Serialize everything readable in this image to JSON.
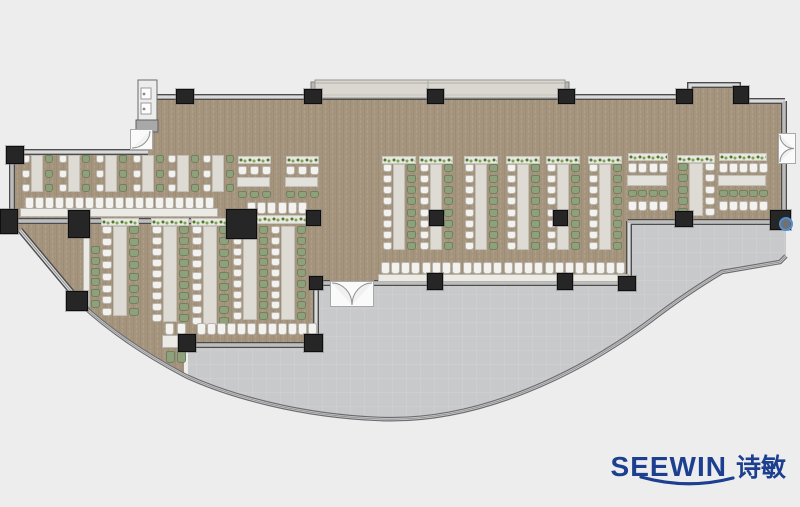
{
  "logo": {
    "brand": "SEEWIN",
    "brand_cn": "诗敏"
  },
  "meta": {
    "background": "#ededee",
    "wood_floor": "#a6957e",
    "terrace": "#c8c9cb",
    "wall_edge": "#4c4c4c",
    "wall_fill": "#dadada",
    "column_color": "#262626",
    "desk": "#dedbd4",
    "chair_white": "#f3f2ef",
    "chair_green": "#8fa07c",
    "plant_green": "#4e7a2d",
    "brand_blue": "#1c3f90",
    "marker_blue": "#4d8fd6"
  },
  "plan": {
    "clusters": [
      {
        "t": "v",
        "x": 381,
        "y": 156,
        "w": 36,
        "h": 94,
        "p": 1,
        "n": 8
      },
      {
        "t": "v",
        "x": 418,
        "y": 156,
        "w": 36,
        "h": 94,
        "p": 1,
        "n": 8
      },
      {
        "t": "v",
        "x": 463,
        "y": 156,
        "w": 36,
        "h": 94,
        "p": 1,
        "n": 8
      },
      {
        "t": "v",
        "x": 505,
        "y": 156,
        "w": 36,
        "h": 94,
        "p": 1,
        "n": 8
      },
      {
        "t": "v",
        "x": 545,
        "y": 156,
        "w": 36,
        "h": 94,
        "p": 1,
        "n": 8
      },
      {
        "t": "v",
        "x": 587,
        "y": 156,
        "w": 36,
        "h": 94,
        "p": 1,
        "n": 8
      },
      {
        "t": "v",
        "x": 20,
        "y": 155,
        "w": 34,
        "h": 37,
        "p": 0,
        "n": 3
      },
      {
        "t": "v",
        "x": 57,
        "y": 155,
        "w": 34,
        "h": 37,
        "p": 0,
        "n": 3
      },
      {
        "t": "v",
        "x": 94,
        "y": 155,
        "w": 34,
        "h": 37,
        "p": 0,
        "n": 3
      },
      {
        "t": "v",
        "x": 131,
        "y": 155,
        "w": 34,
        "h": 37,
        "p": 0,
        "n": 3
      },
      {
        "t": "v",
        "x": 166,
        "y": 155,
        "w": 34,
        "h": 37,
        "p": 0,
        "n": 3
      },
      {
        "t": "v",
        "x": 201,
        "y": 155,
        "w": 34,
        "h": 37,
        "p": 0,
        "n": 3
      },
      {
        "t": "v",
        "x": 100,
        "y": 218,
        "w": 40,
        "h": 98,
        "p": 1,
        "n": 8
      },
      {
        "t": "v",
        "x": 150,
        "y": 218,
        "w": 40,
        "h": 104,
        "p": 1,
        "n": 9
      },
      {
        "t": "v",
        "x": 190,
        "y": 218,
        "w": 40,
        "h": 107,
        "p": 1,
        "n": 9
      },
      {
        "t": "v",
        "x": 231,
        "y": 226,
        "w": 38,
        "h": 94,
        "p": 0,
        "n": 9
      },
      {
        "t": "v",
        "x": 269,
        "y": 226,
        "w": 38,
        "h": 94,
        "p": 0,
        "n": 9
      },
      {
        "t": "v",
        "x": 676,
        "y": 155,
        "w": 40,
        "h": 61,
        "p": 1,
        "n": 5,
        "rev": 1
      },
      {
        "t": "h",
        "x": 237,
        "y": 156,
        "w": 35,
        "rows": [
          [
            "p",
            8
          ],
          [
            "w",
            13
          ],
          [
            "t",
            12
          ],
          [
            "g",
            11
          ]
        ]
      },
      {
        "t": "h",
        "x": 285,
        "y": 156,
        "w": 35,
        "rows": [
          [
            "p",
            8
          ],
          [
            "w",
            13
          ],
          [
            "t",
            12
          ],
          [
            "g",
            11
          ]
        ]
      },
      {
        "t": "h",
        "x": 627,
        "y": 153,
        "w": 42,
        "rows": [
          [
            "p",
            8
          ],
          [
            "w",
            14
          ],
          [
            "t",
            13
          ],
          [
            "g",
            11
          ],
          [
            "w",
            14
          ]
        ]
      },
      {
        "t": "h",
        "x": 718,
        "y": 153,
        "w": 50,
        "rows": [
          [
            "p",
            8
          ],
          [
            "w",
            14
          ],
          [
            "t",
            13
          ],
          [
            "g",
            11
          ],
          [
            "w",
            14
          ]
        ]
      }
    ],
    "chair_rows": [
      {
        "x": 24,
        "y": 196,
        "w": 190,
        "c": "white"
      },
      {
        "x": 246,
        "y": 201,
        "w": 62,
        "c": "white"
      },
      {
        "x": 380,
        "y": 261,
        "w": 246,
        "c": "white"
      },
      {
        "x": 196,
        "y": 322,
        "w": 122,
        "c": "white"
      },
      {
        "x": 163,
        "y": 322,
        "w": 24,
        "c": "white"
      },
      {
        "x": 165,
        "y": 350,
        "w": 22,
        "c": "green"
      }
    ],
    "chair_cols": [
      {
        "x": 90,
        "y": 246,
        "h": 62,
        "c": "green"
      }
    ],
    "counters": [
      {
        "x": 20,
        "y": 208,
        "w": 198,
        "h": 9
      },
      {
        "x": 378,
        "y": 274,
        "w": 251,
        "h": 8
      },
      {
        "x": 83,
        "y": 233,
        "w": 7,
        "h": 74
      },
      {
        "x": 162,
        "y": 335,
        "w": 25,
        "h": 13
      }
    ],
    "plant_strips": [
      {
        "x": 244,
        "y": 215,
        "w": 67,
        "h": 7
      }
    ],
    "columns": [
      [
        176,
        89,
        18,
        15
      ],
      [
        304,
        89,
        18,
        15
      ],
      [
        427,
        89,
        17,
        15
      ],
      [
        558,
        89,
        17,
        15
      ],
      [
        676,
        89,
        17,
        15
      ],
      [
        733,
        86,
        16,
        18
      ],
      [
        770,
        210,
        21,
        20
      ],
      [
        675,
        211,
        18,
        16
      ],
      [
        618,
        276,
        18,
        15
      ],
      [
        427,
        273,
        16,
        17
      ],
      [
        557,
        273,
        16,
        17
      ],
      [
        309,
        276,
        14,
        14
      ],
      [
        304,
        334,
        19,
        18
      ],
      [
        178,
        334,
        18,
        18
      ],
      [
        226,
        209,
        31,
        30
      ],
      [
        306,
        210,
        15,
        16
      ],
      [
        429,
        210,
        15,
        16
      ],
      [
        553,
        210,
        15,
        16
      ],
      [
        6,
        146,
        18,
        18
      ],
      [
        0,
        209,
        18,
        25
      ],
      [
        68,
        210,
        22,
        28
      ],
      [
        66,
        291,
        22,
        20
      ]
    ],
    "doors": [
      {
        "x": 330,
        "y": 281,
        "w": 44,
        "h": 26,
        "type": "double-down"
      },
      {
        "x": 778,
        "y": 133,
        "w": 18,
        "h": 31,
        "type": "double-right"
      },
      {
        "x": 130,
        "y": 129,
        "w": 23,
        "h": 21,
        "type": "single-left"
      }
    ],
    "markers": [
      {
        "x": 786,
        "y": 224,
        "r": 7
      }
    ]
  }
}
